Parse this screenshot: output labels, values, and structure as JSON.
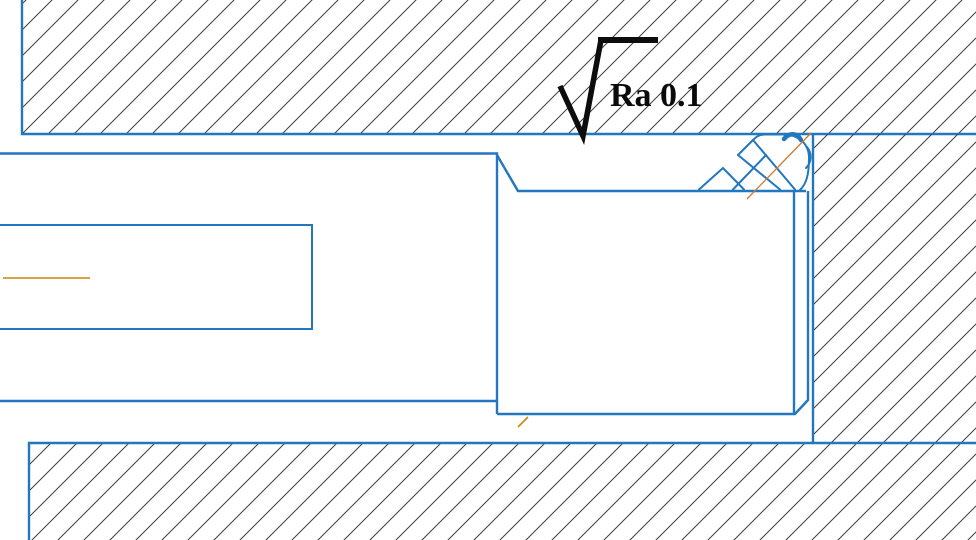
{
  "drawing": {
    "type": "cad-cross-section",
    "description_visible_text_only": true,
    "annotation": {
      "roughness_label": "Ra 0.1"
    },
    "colors": {
      "background": "#ffffff",
      "part_outline_blue": "#2277bf",
      "hatch_line": "#3f3f3f",
      "centerline_orange": "#c8860a",
      "seal_centerline_orange": "#cc7a33",
      "annotation_black": "#0d0d0d"
    },
    "regions": {
      "upper_housing": "hatched section, top of view",
      "right_housing": "hatched section, right of seal gland",
      "lower_housing": "hatched section, bottom of view",
      "rod": "left stepped part with inner bore rectangle",
      "gland": "middle part carrying the seal",
      "seal": "v-packing style seal set in upper right corner of gland"
    }
  }
}
